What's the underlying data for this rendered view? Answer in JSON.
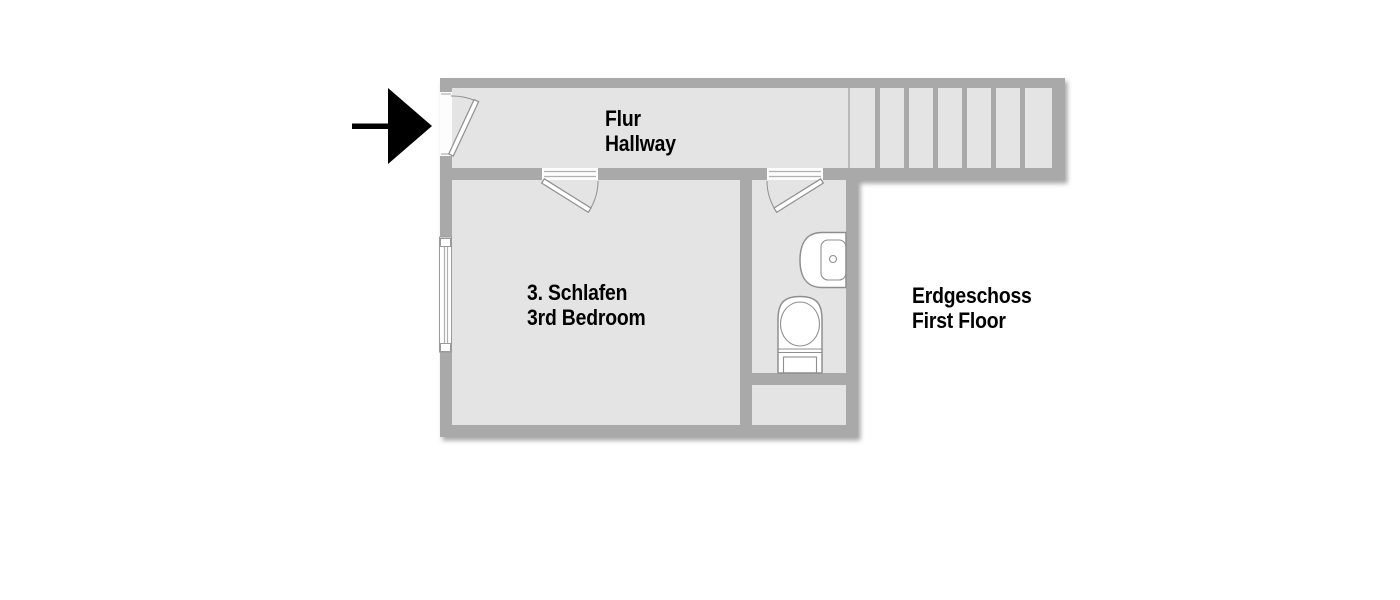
{
  "labels": {
    "hallway": {
      "de": "Flur",
      "en": "Hallway"
    },
    "bedroom": {
      "de": "3. Schlafen",
      "en": "3rd Bedroom"
    },
    "floor": {
      "de": "Erdgeschoss",
      "en": "First Floor"
    }
  },
  "icons": {
    "entrance_marker": "arrow-right"
  },
  "colors": {
    "background": "#ffffff",
    "wall": "#a9a9a9",
    "room": "#e4e4e4",
    "fixture-stroke": "#8f8f8f",
    "arrow": "#000000",
    "text": "#000000"
  }
}
